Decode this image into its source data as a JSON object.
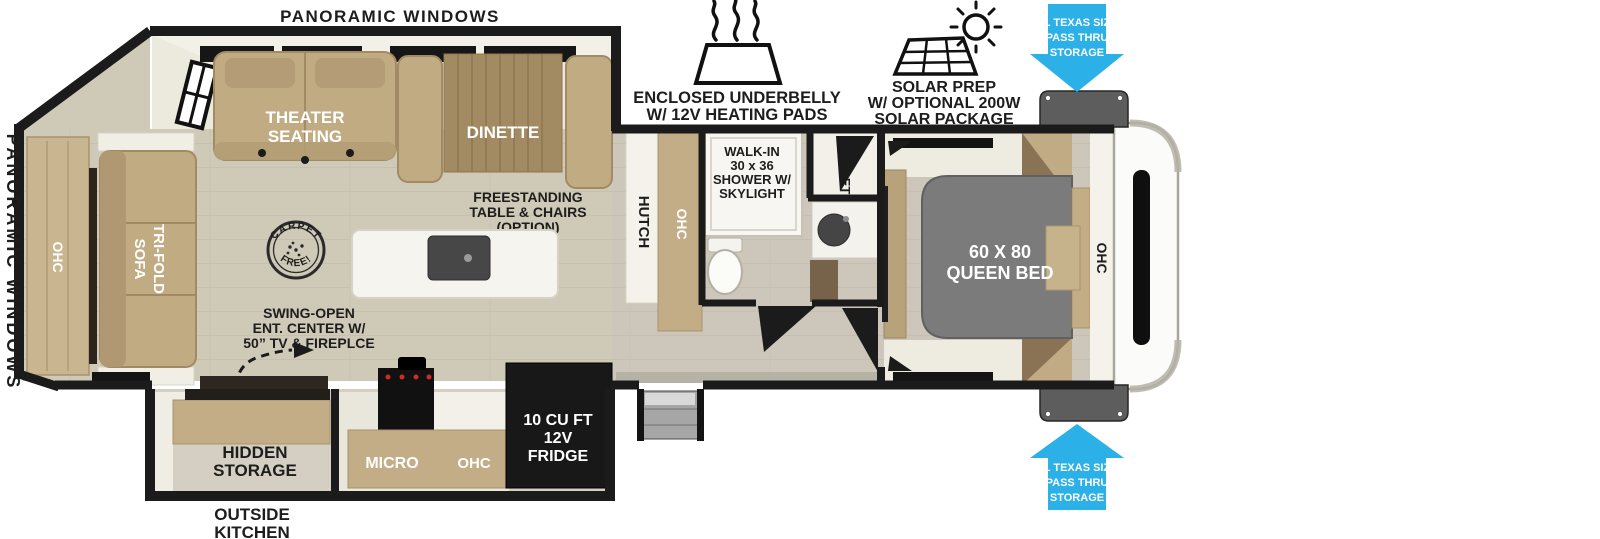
{
  "colors": {
    "accent_blue": "#2CB0E8",
    "wall_black": "#1b1b1b",
    "floor_beige": "#cfc9b8",
    "furniture_tan": "#c1ab83",
    "table_wood": "#a28a63",
    "bed_gray": "#7b7b7b",
    "white_surface": "#f4f2ec"
  },
  "exterior_labels": {
    "panoramic_windows_top": "PANORAMIC WINDOWS",
    "panoramic_windows_side": "PANORAMIC WINDOWS",
    "outside_kitchen": {
      "line1": "OUTSIDE",
      "line2": "KITCHEN"
    }
  },
  "feature_callouts": {
    "underbelly": {
      "icon": "heating-pad-icon",
      "line1": "ENCLOSED UNDERBELLY",
      "line2": "W/ 12V HEATING PADS"
    },
    "solar": {
      "icon": "solar-panel-sun-icon",
      "line1": "SOLAR PREP",
      "line2": "W/ OPTIONAL 200W",
      "line3": "SOLAR PACKAGE"
    },
    "pass_thru_front_top": {
      "icon": "blue-arrow-down-icon",
      "line1": "XL TEXAS SIZE",
      "line2": "PASS THRU",
      "line3": "STORAGE"
    },
    "pass_thru_front_bottom": {
      "icon": "blue-arrow-up-icon",
      "line1": "XL TEXAS SIZE",
      "line2": "PASS THRU",
      "line3": "STORAGE"
    }
  },
  "interior_labels": {
    "theater_seating": {
      "line1": "THEATER",
      "line2": "SEATING"
    },
    "dinette": "DINETTE",
    "freestanding_option": {
      "line1": "FREESTANDING",
      "line2": "TABLE & CHAIRS",
      "line3": "(OPTION)"
    },
    "carpet_free": {
      "top": "CARPET",
      "bottom": "FREE!"
    },
    "swing_open": {
      "line1": "SWING-OPEN",
      "line2": "ENT. CENTER W/",
      "line3": "50” TV & FIREPLCE"
    },
    "tri_fold_sofa": {
      "line1": "TRI-FOLD",
      "line2": "SOFA"
    },
    "ohc_rear": "OHC",
    "hutch": "HUTCH",
    "ohc_hutch": "OHC",
    "shower": {
      "line1": "WALK-IN",
      "line2": "30 x 36",
      "line3": "SHOWER W/",
      "line4": "SKYLIGHT"
    },
    "closet": "CLOSET",
    "queen_bed": {
      "line1": "60 X 80",
      "line2": "QUEEN BED"
    },
    "ohc_bedroom": "OHC",
    "hidden_storage": {
      "line1": "HIDDEN",
      "line2": "STORAGE"
    },
    "micro": "MICRO",
    "ohc_kitchen": "OHC",
    "fridge": {
      "line1": "10 CU FT",
      "line2": "12V",
      "line3": "FRIDGE"
    }
  }
}
